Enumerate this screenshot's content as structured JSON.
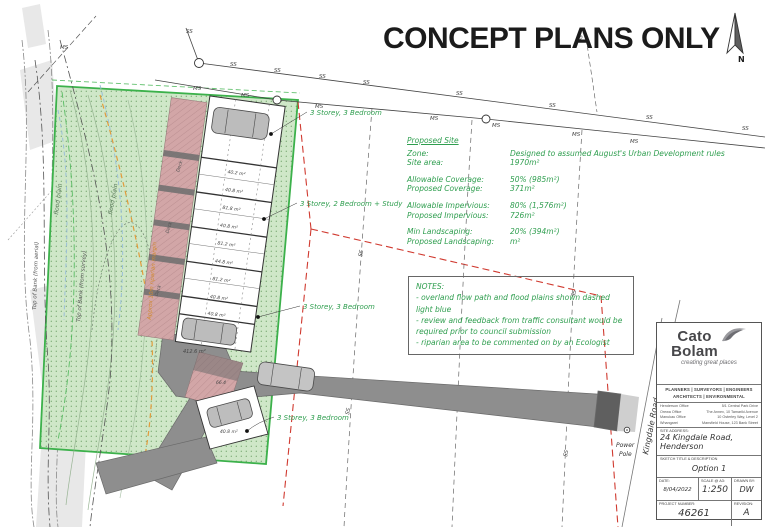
{
  "title": "CONCEPT PLANS ONLY",
  "north_label": "N",
  "proposed_site": {
    "heading": "Proposed Site",
    "rows": [
      {
        "label": "Zone:",
        "value": "Designed to assumed August's Urban Development rules"
      },
      {
        "label": "Site area:",
        "value": "1970m²"
      },
      {
        "label": "Allowable Coverage:",
        "value": "50% (985m²)"
      },
      {
        "label": "Proposed Coverage:",
        "value": "371m²"
      },
      {
        "label": "Allowable Impervious:",
        "value": "80% (1,576m²)"
      },
      {
        "label": "Proposed Impervious:",
        "value": "726m²"
      },
      {
        "label": "Min Landscaping:",
        "value": "20% (394m²)"
      },
      {
        "label": "Proposed Landscaping:",
        "value": "m²"
      }
    ]
  },
  "notes": {
    "heading": "NOTES:",
    "line1": "- overland flow path and flood plains shown dashed",
    "line2": "light blue",
    "line3": "- review and feedback from traffic consultant would be",
    "line4": "required prior to council submission",
    "line5": "- riparian area to be commented on by an Ecologist"
  },
  "plan": {
    "unit_label_top": "3 Storey, 3 Bedroom",
    "unit_label_mid": "3 Storey, 2 Bedroom + Study",
    "unit_label_lower": "3 Storey, 3 Bedroom",
    "unit_label_bottom": "3 Storey, 3 Bedroom",
    "areas": [
      "40.2 m²",
      "40.8 m²",
      "81.8 m²",
      "40.8 m²",
      "81.2 m²",
      "44.8 m²",
      "81.2 m²",
      "40.8 m²",
      "40.8 m²"
    ],
    "area_lot": "412.6 m²",
    "area_66": "66.4",
    "area_bottom": "40.8 m²",
    "deck": "Deck",
    "ss": "SS",
    "ms": "MS",
    "flood_plain": "flood plain",
    "top_of_bank_survey": "Top of Bank (from survey)",
    "top_of_bank_aerial": "Top of Bank (from aerial)",
    "riparian_margin": "Approx 10m riparian margin",
    "road_name": "Kingdale Road",
    "power_pole_1": "Power",
    "power_pole_2": "Pole"
  },
  "title_block": {
    "brand_1": "Cato",
    "brand_2": "Bolam",
    "tagline": "creating great places",
    "services_1": "PLANNERS | SURVEYORS | ENGINEERS",
    "services_2": "ARCHITECTS | ENVIRONMENTAL",
    "offices": [
      {
        "name": "Henderson Office",
        "address": "5/1 Central Park Drive"
      },
      {
        "name": "Orewa Office",
        "address": "The Annex, 10 Tamariki Avenue"
      },
      {
        "name": "Manukau Office",
        "address": "10 Osterley Way, Level 2"
      },
      {
        "name": "Whangarei",
        "address": "Mansfield House, 123 Bank Street"
      }
    ],
    "site_address_label": "SITE ADDRESS:",
    "site_address_1": "24 Kingdale Road,",
    "site_address_2": "Henderson",
    "sketch_label": "SKETCH TITLE & DESCRIPTION",
    "sketch_title": "Option 1",
    "date_label": "DATE:",
    "date": "8/04/2022",
    "scale_label": "SCALE @ A3:",
    "scale": "1:250",
    "drawn_label": "DRAWN BY:",
    "drawn_by": "DW",
    "project_label": "PROJECT NUMBER:",
    "project_number": "46261",
    "revision_label": "REVISION:",
    "revision": "A"
  },
  "colors": {
    "green_text": "#2f9e4f",
    "site_green": "#3cb14b",
    "landscape_fill": "#cfe7c8",
    "deck_pink": "#d2a6a7",
    "road_gray": "#8e8e8e",
    "red_boundary": "#d03a30",
    "riparian_orange": "#e29b3b",
    "title_black": "#1b1b1b"
  }
}
